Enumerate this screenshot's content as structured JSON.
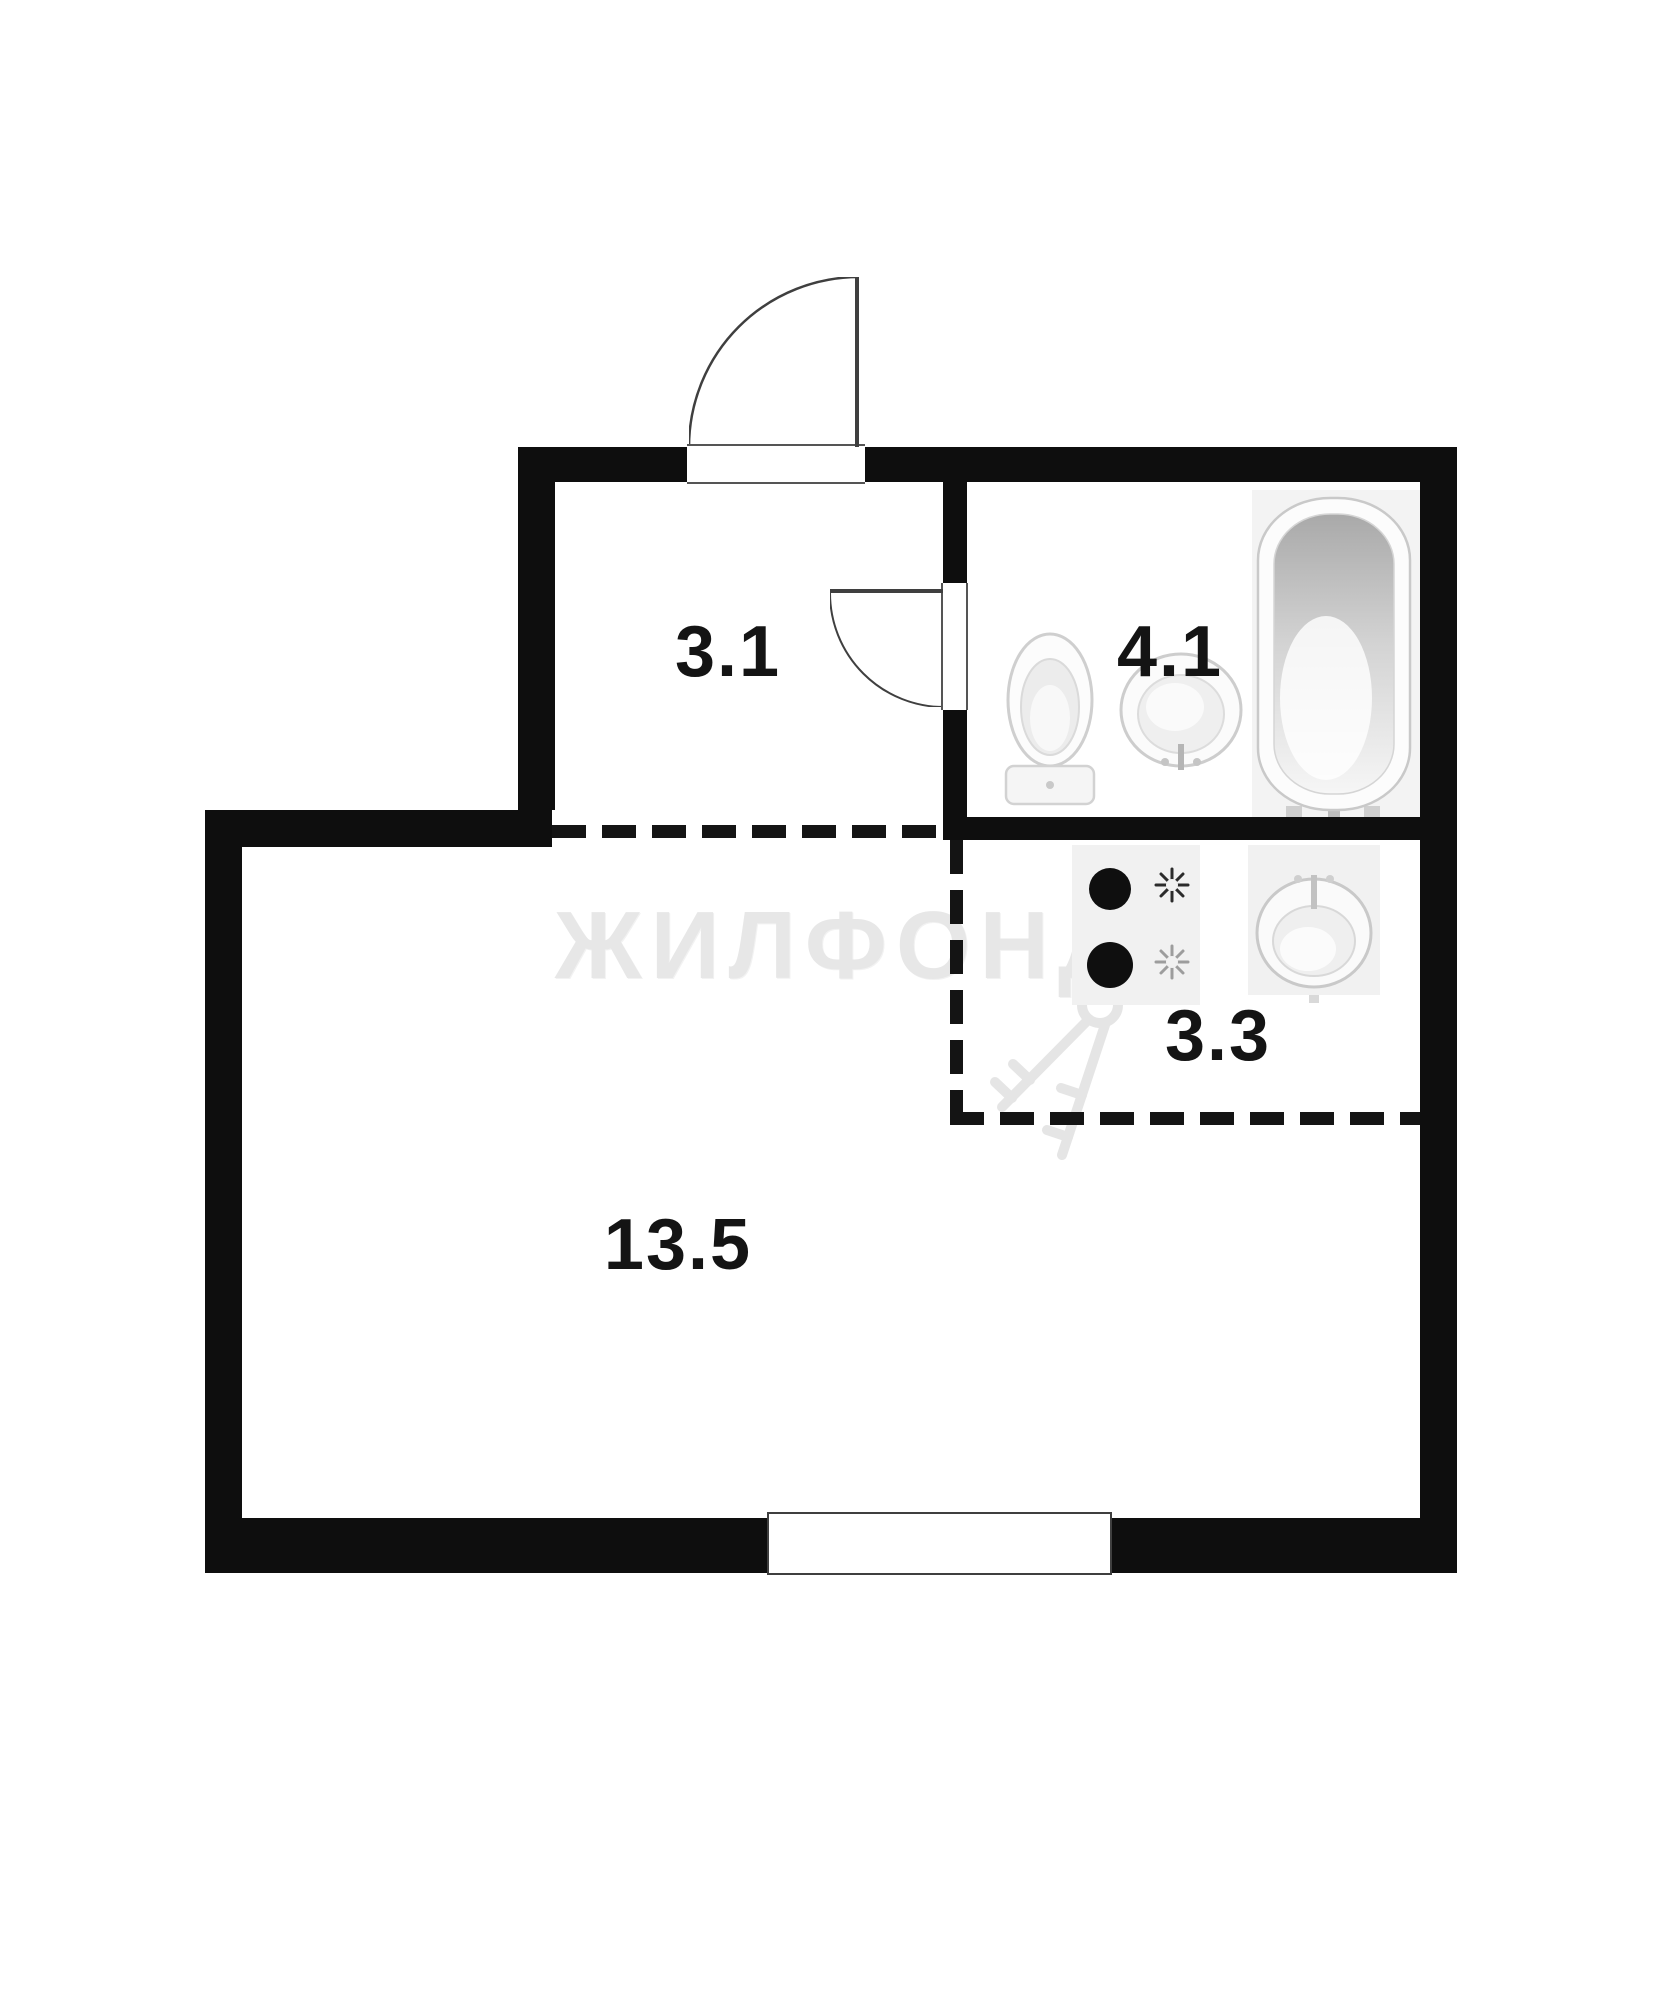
{
  "watermark": {
    "text": "ЖИЛФОНД",
    "keys_icon": "keys-icon"
  },
  "rooms": [
    {
      "id": "hallway",
      "label": "3.1"
    },
    {
      "id": "bathroom",
      "label": "4.1"
    },
    {
      "id": "kitchen",
      "label": "3.3"
    },
    {
      "id": "living-room",
      "label": "13.5"
    }
  ],
  "fixtures": [
    {
      "icon": "toilet-icon",
      "room": "bathroom"
    },
    {
      "icon": "sink-icon",
      "room": "bathroom"
    },
    {
      "icon": "bathtub-icon",
      "room": "bathroom"
    },
    {
      "icon": "stove-icon",
      "room": "kitchen"
    },
    {
      "icon": "kitchen-sink-icon",
      "room": "kitchen"
    }
  ],
  "doors": [
    {
      "name": "entrance-door",
      "type": "swing-out",
      "location": "top-wall"
    },
    {
      "name": "bathroom-door",
      "type": "swing-in",
      "location": "hallway-bathroom-wall"
    }
  ],
  "window": {
    "name": "window",
    "location": "bottom-wall"
  },
  "colors": {
    "wall": "#0e0e0e",
    "dashed_line": "#141414",
    "door_line": "#3f3f3f",
    "fixture_outline": "#cccccc",
    "fixture_panel": "#f1f1f1",
    "watermark": "#e7e7e7",
    "background": "#ffffff"
  }
}
